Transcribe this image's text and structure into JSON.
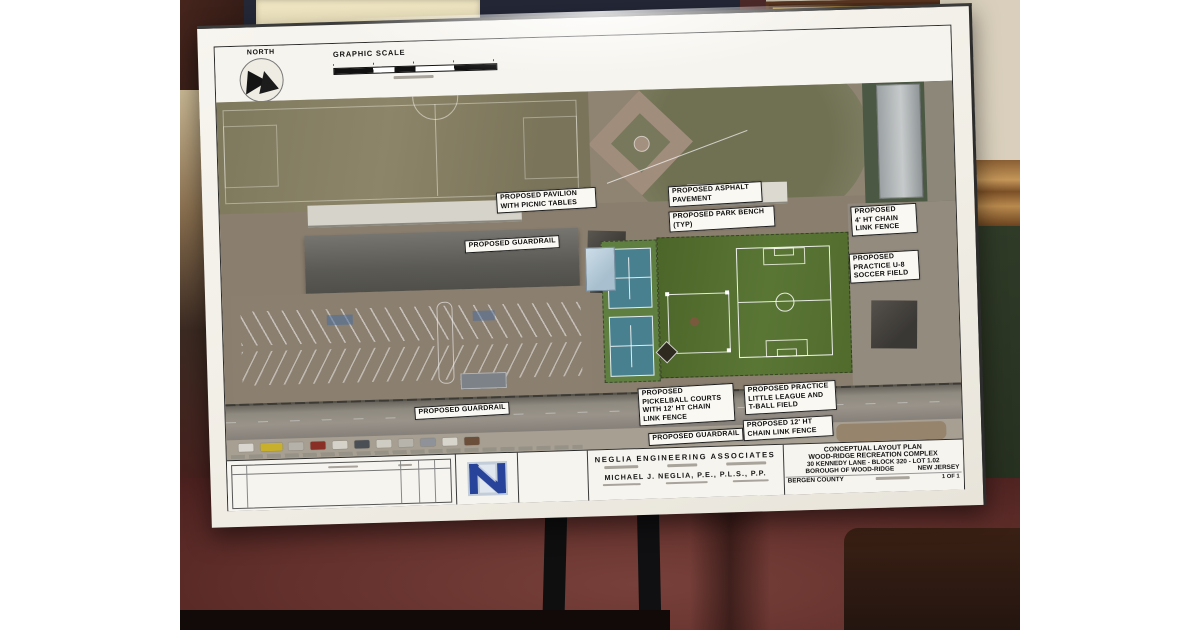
{
  "plan": {
    "north_label": "NORTH",
    "graphic_scale_label": "GRAPHIC SCALE",
    "annotations": [
      {
        "key": "pavilion",
        "text": "PROPOSED PAVILION\nWITH PICNIC TABLES"
      },
      {
        "key": "guardrail-upper",
        "text": "PROPOSED GUARDRAIL"
      },
      {
        "key": "asphalt",
        "text": "PROPOSED ASPHALT\nPAVEMENT"
      },
      {
        "key": "park-bench",
        "text": "PROPOSED PARK BENCH\n(TYP)"
      },
      {
        "key": "fence-4ft",
        "text": "PROPOSED\n4' HT CHAIN\nLINK FENCE"
      },
      {
        "key": "u8-soccer",
        "text": "PROPOSED\nPRACTICE U-8\nSOCCER FIELD"
      },
      {
        "key": "guardrail-left",
        "text": "PROPOSED GUARDRAIL"
      },
      {
        "key": "pickleball",
        "text": "PROPOSED\nPICKELBALL COURTS\nWITH 12' HT CHAIN\nLINK FENCE"
      },
      {
        "key": "guardrail-mid",
        "text": "PROPOSED GUARDRAIL"
      },
      {
        "key": "little-league",
        "text": "PROPOSED PRACTICE\nLITTLE LEAGUE AND\nT-BALL FIELD"
      },
      {
        "key": "fence-12ft",
        "text": "PROPOSED 12' HT\nCHAIN LINK FENCE"
      }
    ],
    "title_block": {
      "firm_name": "NEGLIA ENGINEERING ASSOCIATES",
      "engineer_name": "MICHAEL J. NEGLIA, P.E., P.L.S., P.P.",
      "project_line1": "CONCEPTUAL LAYOUT PLAN",
      "project_line2": "WOOD-RIDGE RECREATION COMPLEX",
      "project_line3": "30 KENNEDY LANE - BLOCK 320 - LOT 1.02",
      "project_line4": "BOROUGH OF WOOD-RIDGE",
      "county": "BERGEN COUNTY",
      "state": "NEW JERSEY",
      "sheet_number": "1 OF 1"
    },
    "colors": {
      "proposed_field_green": "#53692c",
      "pickleball_blue": "#49808f",
      "pavilion_blue": "#bacfdc",
      "logo_navy": "#27439a"
    }
  }
}
